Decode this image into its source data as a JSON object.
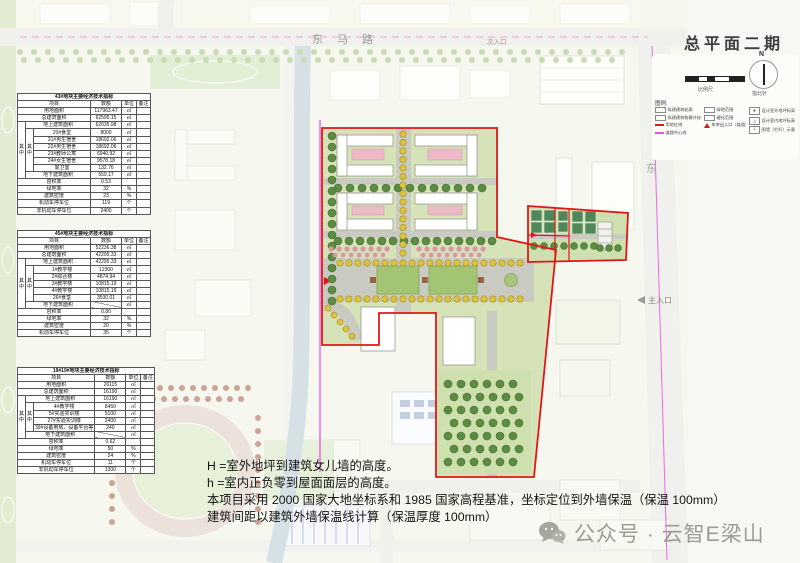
{
  "title": "总平面二期",
  "scale": {
    "caption": "比例尺"
  },
  "compass": {
    "caption": "指北针",
    "north": "N"
  },
  "legend": {
    "label": "图例:",
    "columns": [
      [
        {
          "swatch": "box",
          "label": "拟建建筑轮廓"
        },
        {
          "swatch": "box",
          "label": "拟建建筑物最外轮廓"
        },
        {
          "swatch": "line-red",
          "label": "用地红线"
        },
        {
          "swatch": "line-magenta",
          "label": "道路中心线"
        }
      ],
      [
        {
          "swatch": "box",
          "label": "绿地范围"
        },
        {
          "swatch": "box",
          "label": "硬化范围"
        },
        {
          "swatch": "tri",
          "label": "车库出入口（坡道）"
        }
      ],
      [
        {
          "swatch": "mark",
          "glyph": "▼",
          "label": "设计室外地坪标高"
        },
        {
          "swatch": "mark",
          "glyph": "△",
          "label": "设计室内地坪标高"
        },
        {
          "swatch": "mark",
          "glyph": "┴",
          "label": "围墙（栏杆）示意"
        }
      ]
    ]
  },
  "map_labels": {
    "road_top": "东马路",
    "secondary_entrance": "次入口",
    "main_entrance": "主入口",
    "road_right": "东"
  },
  "tables": [
    {
      "caption": "43#地块主要经济技术指标",
      "headers": [
        "项目",
        "数额",
        "单位",
        "备注"
      ],
      "group_label": "其中",
      "rows": [
        {
          "label": "用地面积",
          "value": "117963.47",
          "unit": "㎡",
          "level": 0
        },
        {
          "label": "总建筑面积",
          "value": "62595.15",
          "unit": "㎡",
          "level": 0
        },
        {
          "label": "地上建筑面积",
          "value": "62035.98",
          "unit": "㎡",
          "level": 1
        },
        {
          "label": "20#食堂",
          "value": "8000",
          "unit": "㎡",
          "level": 2
        },
        {
          "label": "21#男生宿舍",
          "value": "18692.06",
          "unit": "㎡",
          "level": 2
        },
        {
          "label": "22#男生宿舍",
          "value": "18692.06",
          "unit": "㎡",
          "level": 2
        },
        {
          "label": "23#教师公寓",
          "value": "6940.92",
          "unit": "㎡",
          "level": 2
        },
        {
          "label": "24#女生宿舍",
          "value": "9578.18",
          "unit": "㎡",
          "level": 2
        },
        {
          "label": "警卫室",
          "value": "132.76",
          "unit": "㎡",
          "level": 2
        },
        {
          "label": "地下建筑面积",
          "value": "559.17",
          "unit": "㎡",
          "level": 1
        },
        {
          "label": "容积率",
          "value": "0.53",
          "unit": "",
          "level": 0
        },
        {
          "label": "绿地率",
          "value": "32",
          "unit": "%",
          "level": 0
        },
        {
          "label": "建筑密度",
          "value": "23",
          "unit": "%",
          "level": 0
        },
        {
          "label": "机动车停车位",
          "value": "119",
          "unit": "个",
          "level": 0
        },
        {
          "label": "非机动车停车位",
          "value": "2400",
          "unit": "个",
          "level": 0
        }
      ]
    },
    {
      "caption": "45#地块主要经济技术指标",
      "headers": [
        "项目",
        "数额",
        "单位",
        "备注"
      ],
      "group_label": "其中",
      "rows": [
        {
          "label": "用地面积",
          "value": "52236.38",
          "unit": "㎡",
          "level": 0
        },
        {
          "label": "总建筑面积",
          "value": "42295.33",
          "unit": "㎡",
          "level": 0
        },
        {
          "label": "地上建筑面积",
          "value": "42295.33",
          "unit": "㎡",
          "level": 1
        },
        {
          "label": "1#教学楼",
          "value": "12300",
          "unit": "㎡",
          "level": 2
        },
        {
          "label": "2#综合楼",
          "value": "4874.94",
          "unit": "㎡",
          "level": 2
        },
        {
          "label": "3#教学楼",
          "value": "10815.19",
          "unit": "㎡",
          "level": 2
        },
        {
          "label": "4#教学楼",
          "value": "10815.19",
          "unit": "㎡",
          "level": 2
        },
        {
          "label": "26#食堂",
          "value": "3530.01",
          "unit": "㎡",
          "level": 2
        },
        {
          "label": "地下建筑面积",
          "value": "",
          "unit": "㎡",
          "level": 1,
          "diag": true
        },
        {
          "label": "容积率",
          "value": "0.80",
          "unit": "",
          "level": 0
        },
        {
          "label": "绿地率",
          "value": "32",
          "unit": "%",
          "level": 0
        },
        {
          "label": "建筑密度",
          "value": "20",
          "unit": "%",
          "level": 0
        },
        {
          "label": "机动车停车位",
          "value": "35",
          "unit": "个",
          "level": 0
        }
      ]
    },
    {
      "caption": "19#19#地块主要经济技术指标",
      "headers": [
        "项目",
        "数额",
        "单位",
        "备注"
      ],
      "group_label": "其中",
      "rows": [
        {
          "label": "用地面积",
          "value": "26115",
          "unit": "㎡",
          "level": 0
        },
        {
          "label": "总建筑面积",
          "value": "16190",
          "unit": "㎡",
          "level": 0
        },
        {
          "label": "地上建筑面积",
          "value": "16190",
          "unit": "㎡",
          "level": 1
        },
        {
          "label": "4#教学楼",
          "value": "8450",
          "unit": "㎡",
          "level": 2
        },
        {
          "label": "5#实验实训楼",
          "value": "5100",
          "unit": "㎡",
          "level": 2
        },
        {
          "label": "27#实验实训楼",
          "value": "2400",
          "unit": "㎡",
          "level": 2
        },
        {
          "label": "39#设备用房、设备平台等",
          "value": "240",
          "unit": "㎡",
          "level": 2
        },
        {
          "label": "地下建筑面积",
          "value": "",
          "unit": "㎡",
          "level": 1,
          "diag": true
        },
        {
          "label": "容积率",
          "value": "0.62",
          "unit": "",
          "level": 0
        },
        {
          "label": "绿地率",
          "value": "50",
          "unit": "%",
          "level": 0
        },
        {
          "label": "建筑密度",
          "value": "24",
          "unit": "%",
          "level": 0
        },
        {
          "label": "机动车停车位",
          "value": "11",
          "unit": "个",
          "level": 0
        },
        {
          "label": "非机动车停车位",
          "value": "1300",
          "unit": "个",
          "level": 0
        }
      ]
    }
  ],
  "notes": [
    "H =室外地坪到建筑女儿墙的高度。",
    "h =室内正负零到屋面面层的高度。",
    "本项目采用 2000 国家大地坐标系和 1985 国家高程基准，坐标定位到外墙保温（保温 100mm）",
    "建筑间距以建筑外墙保温线计算（保温厚度 100mm）"
  ],
  "watermark": {
    "text": "公众号 · 云智E梁山"
  },
  "colors": {
    "parcel_outline": "#e11717",
    "centerline": "#ea52e0"
  }
}
